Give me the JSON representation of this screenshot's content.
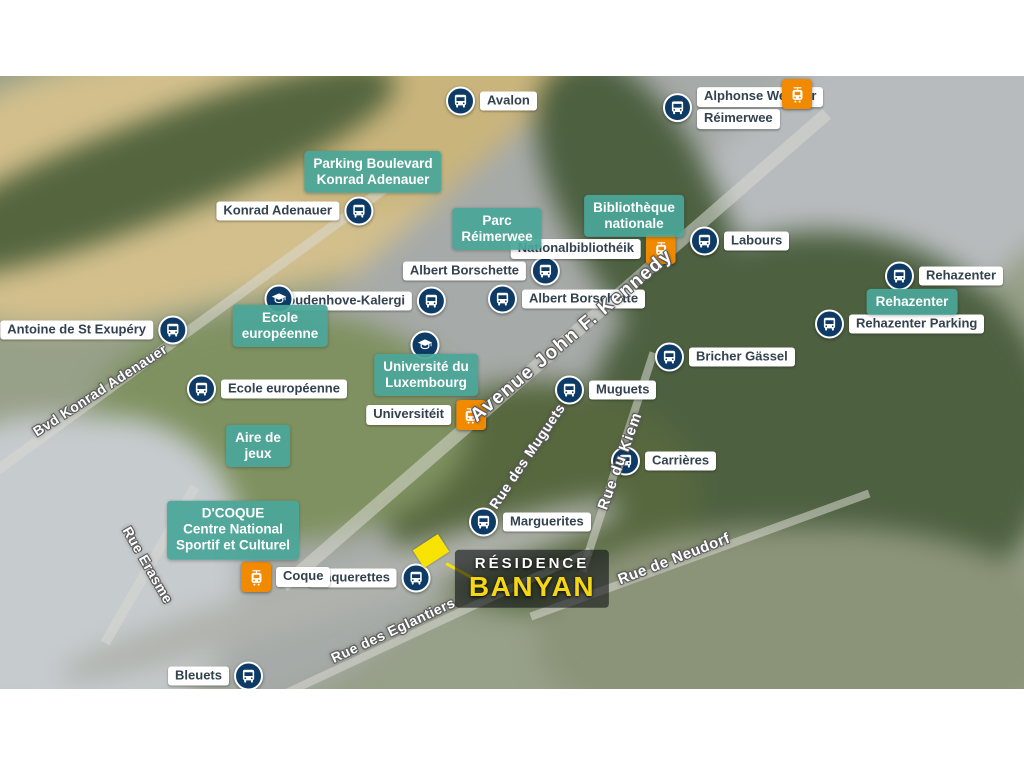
{
  "colors": {
    "bus_navy": "#0e3a66",
    "tram_orange": "#f18a00",
    "poi_teal": "rgba(74,166,153,0.93)",
    "label_text": "#33424f",
    "banyan_yellow": "#f5d713",
    "parcel_yellow": "#f8e300"
  },
  "map": {
    "bus_stops": [
      {
        "label": "Avalon",
        "x": 461,
        "y": 101,
        "side": "right"
      },
      {
        "label": "Alphonse Weicker",
        "label2": "Réimerwee",
        "x": 678,
        "y": 108,
        "side": "right"
      },
      {
        "label": "Konrad Adenauer",
        "x": 358,
        "y": 211,
        "side": "left"
      },
      {
        "label": "Labours",
        "x": 705,
        "y": 241,
        "side": "right"
      },
      {
        "label": "Albert Borschette",
        "x": 545,
        "y": 271,
        "side": "left"
      },
      {
        "label": "Albert Borschette",
        "x": 503,
        "y": 299,
        "side": "right"
      },
      {
        "label": "Coudenhove-Kalergi",
        "x": 431,
        "y": 301,
        "side": "left"
      },
      {
        "label": "Rehazenter",
        "x": 900,
        "y": 276,
        "side": "right"
      },
      {
        "label": "Rehazenter Parking",
        "x": 830,
        "y": 324,
        "side": "right"
      },
      {
        "label": "Antoine de St Exupéry",
        "x": 172,
        "y": 330,
        "side": "left"
      },
      {
        "label": "Ecole européenne",
        "x": 202,
        "y": 389,
        "side": "right"
      },
      {
        "label": "Bricher Gässel",
        "x": 670,
        "y": 357,
        "side": "right"
      },
      {
        "label": "Muguets",
        "x": 570,
        "y": 390,
        "side": "right"
      },
      {
        "label": "Carrières",
        "x": 626,
        "y": 461,
        "side": "right"
      },
      {
        "label": "Marguerites",
        "x": 484,
        "y": 522,
        "side": "right"
      },
      {
        "label": "Pâquerettes",
        "x": 416,
        "y": 578,
        "side": "left"
      },
      {
        "label": "Bleuets",
        "x": 248,
        "y": 676,
        "side": "left"
      }
    ],
    "tram_stops": [
      {
        "label": "",
        "x": 798,
        "y": 94,
        "side": "none"
      },
      {
        "label": "Nationalbibliothéik",
        "x": 660,
        "y": 249,
        "side": "left"
      },
      {
        "label": "Universitéit",
        "x": 470,
        "y": 415,
        "side": "left"
      },
      {
        "label": "Coque",
        "x": 257,
        "y": 577,
        "side": "right"
      }
    ],
    "poi_labels": [
      {
        "lines": [
          "Parking Boulevard",
          "Konrad Adenauer"
        ],
        "x": 373,
        "y": 172
      },
      {
        "lines": [
          "Parc",
          "Réimerwee"
        ],
        "x": 497,
        "y": 229
      },
      {
        "lines": [
          "Bibliothèque",
          "nationale"
        ],
        "x": 634,
        "y": 216
      },
      {
        "lines": [
          "Ecole",
          "européenne"
        ],
        "x": 280,
        "y": 326,
        "cap": {
          "x": 279,
          "y": 299
        }
      },
      {
        "lines": [
          "Université du",
          "Luxembourg"
        ],
        "x": 426,
        "y": 375,
        "cap": {
          "x": 425,
          "y": 345
        }
      },
      {
        "lines": [
          "Aire de",
          "jeux"
        ],
        "x": 258,
        "y": 446
      },
      {
        "lines": [
          "Rehazenter"
        ],
        "x": 912,
        "y": 302
      },
      {
        "lines": [
          "D'COQUE",
          "Centre National",
          "Sportif et Culturel"
        ],
        "x": 233,
        "y": 530
      }
    ],
    "street_labels": [
      {
        "text": "Avenue John F. Kennedy",
        "x": 572,
        "y": 336,
        "angle": -40,
        "size": 19,
        "spacing": 1.5
      },
      {
        "text": "Bvd Konrad Adenauer",
        "x": 100,
        "y": 390,
        "angle": -33,
        "size": 14,
        "spacing": 0.5
      },
      {
        "text": "Rue Erasme",
        "x": 148,
        "y": 565,
        "angle": 60,
        "size": 14,
        "spacing": 0.5
      },
      {
        "text": "Rue des Muguets",
        "x": 527,
        "y": 456,
        "angle": -56,
        "size": 14,
        "spacing": 0.5
      },
      {
        "text": "Rue du Kiem",
        "x": 620,
        "y": 461,
        "angle": -70,
        "size": 15,
        "spacing": 1
      },
      {
        "text": "Rue de Neudorf",
        "x": 674,
        "y": 559,
        "angle": -21,
        "size": 15,
        "spacing": 0.5
      },
      {
        "text": "Rue des Eglantiers",
        "x": 393,
        "y": 630,
        "angle": -25,
        "size": 14,
        "spacing": 0.5
      }
    ],
    "property": {
      "line1": "RÉSIDENCE",
      "line2": "BANYAN",
      "label_x": 532,
      "label_y": 579,
      "parcel": {
        "x": 431,
        "y": 551,
        "w": 30,
        "h": 21
      },
      "pointer": {
        "x1": 446,
        "y1": 562,
        "x2": 477,
        "y2": 579
      }
    }
  }
}
